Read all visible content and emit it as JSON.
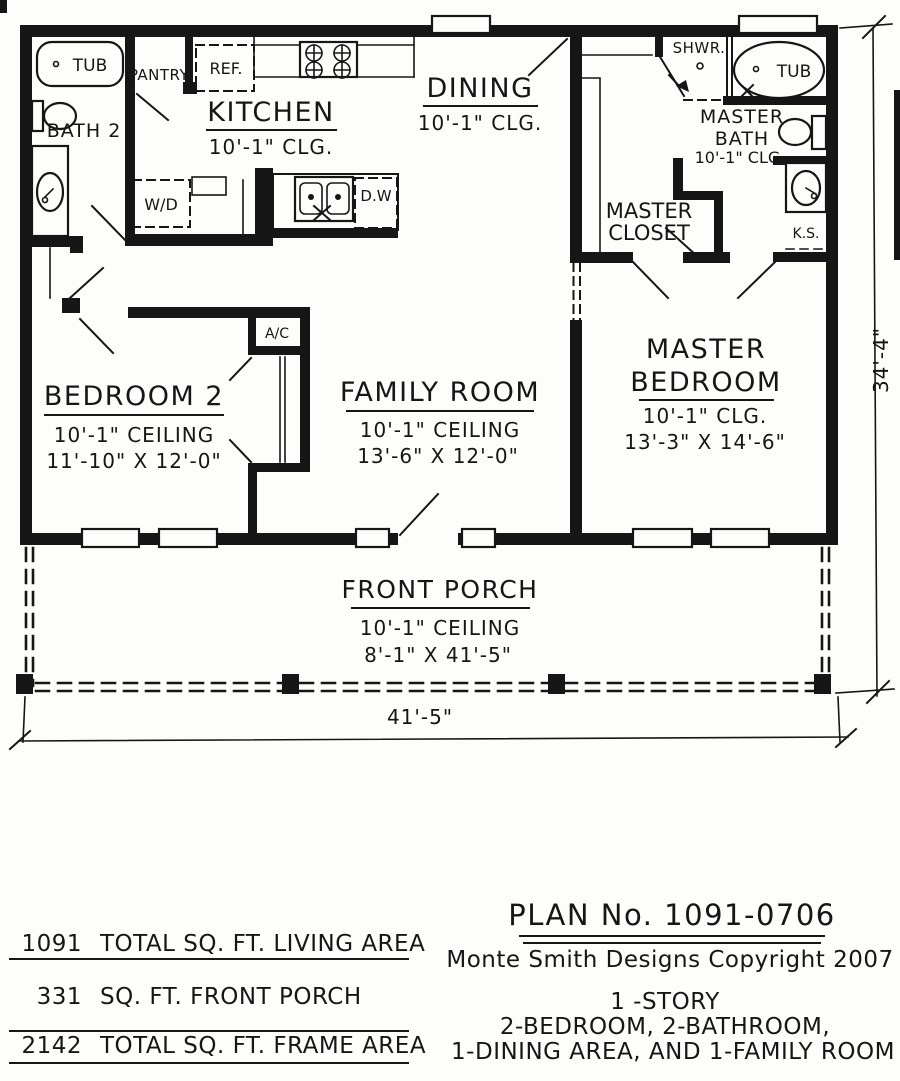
{
  "rooms": {
    "kitchen": {
      "name": "KITCHEN",
      "ceiling": "10'-1\" CLG."
    },
    "dining": {
      "name": "DINING",
      "ceiling": "10'-1\" CLG."
    },
    "bath2": {
      "name": "BATH 2"
    },
    "master_bath": {
      "name_line1": "MASTER",
      "name_line2": "BATH",
      "ceiling": "10'-1\" CLG."
    },
    "master_closet": {
      "name_line1": "MASTER",
      "name_line2": "CLOSET"
    },
    "bedroom2": {
      "name": "BEDROOM 2",
      "ceiling": "10'-1\" CEILING",
      "size": "11'-10\" X 12'-0\""
    },
    "family_room": {
      "name": "FAMILY ROOM",
      "ceiling": "10'-1\" CEILING",
      "size": "13'-6\" X 12'-0\""
    },
    "master_bedroom": {
      "name_line1": "MASTER",
      "name_line2": "BEDROOM",
      "ceiling": "10'-1\" CLG.",
      "size": "13'-3\" X 14'-6\""
    },
    "front_porch": {
      "name": "FRONT PORCH",
      "ceiling": "10'-1\" CEILING",
      "size": "8'-1\" X 41'-5\""
    }
  },
  "fixtures": {
    "bath2_tub": "TUB",
    "pantry": "PANTRY",
    "fridge": "REF.",
    "washer_dryer": "W/D",
    "dishwasher": "D.W",
    "shower": "SHWR.",
    "master_tub": "TUB",
    "knee_space": "K.S.",
    "ac_unit": "A/C"
  },
  "dimensions": {
    "overall_width": "41'-5\"",
    "overall_depth": "34'-4\""
  },
  "footer": {
    "stats": [
      {
        "value": "1091",
        "label": "TOTAL SQ. FT. LIVING AREA"
      },
      {
        "value": "331",
        "label": "SQ. FT. FRONT PORCH"
      },
      {
        "value": "2142",
        "label": "TOTAL SQ. FT. FRAME AREA"
      }
    ],
    "plan_number": "PLAN No. 1091-0706",
    "copyright": "Monte Smith Designs Copyright 2007",
    "description": [
      "1 -STORY",
      "2-BEDROOM, 2-BATHROOM,",
      "1-DINING AREA, AND 1-FAMILY ROOM"
    ]
  }
}
